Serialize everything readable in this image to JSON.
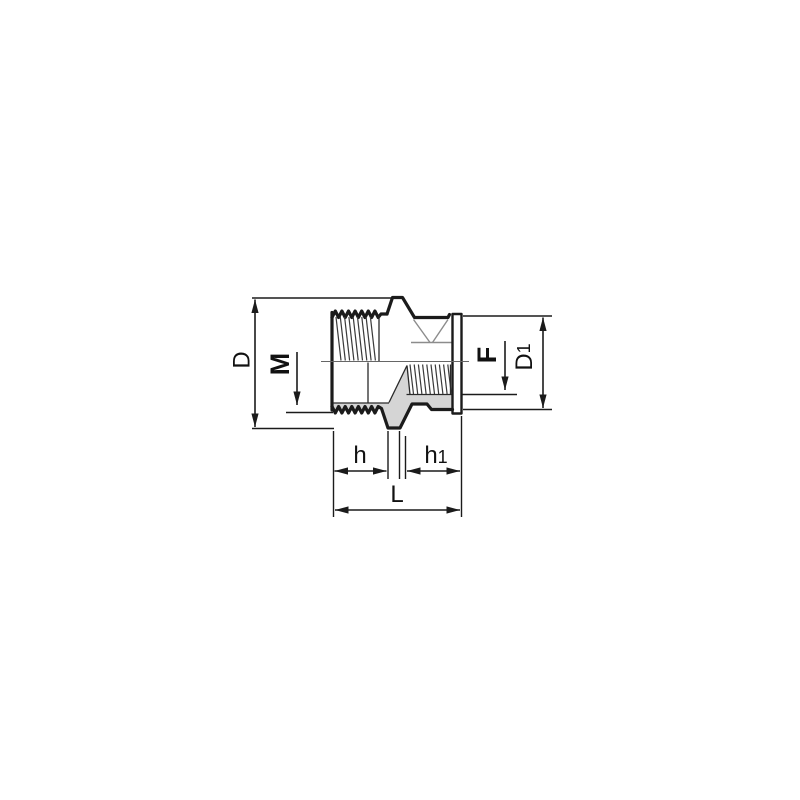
{
  "drawing": {
    "type": "technical-dimension-drawing",
    "subject": "threaded reducing adapter, male x female, half-section view",
    "labels": {
      "D": "D",
      "M": "M",
      "F": "F",
      "D1_main": "D",
      "D1_sub": "1",
      "h": "h",
      "h1_main": "h",
      "h1_sub": "1",
      "L": "L"
    },
    "colors": {
      "line": "#1b1b1b",
      "section_fill": "#d5d5d5",
      "background": "#ffffff"
    }
  }
}
